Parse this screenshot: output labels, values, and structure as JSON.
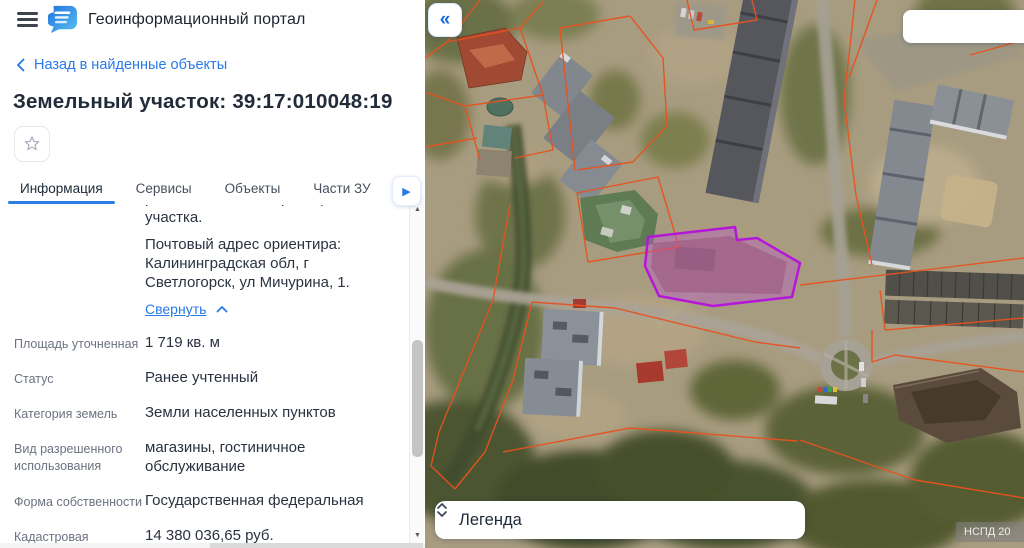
{
  "app": {
    "title": "Геоинформационный портал"
  },
  "back_link": {
    "label": "Назад в найденные объекты"
  },
  "object_title": "Земельный участок: 39:17:010048:19",
  "tabs": [
    {
      "label": "Информация",
      "active": true
    },
    {
      "label": "Сервисы",
      "active": false
    },
    {
      "label": "Объекты",
      "active": false
    },
    {
      "label": "Части ЗУ",
      "active": false
    },
    {
      "label": "Состав",
      "active": false
    }
  ],
  "description": {
    "clipped_line": "расположенного в границах участка.",
    "line2": "Почтовый адрес ориентира:",
    "line3": "Калининградская обл, г",
    "line4": "Светлогорск, ул Мичурина, 1.",
    "collapse_label": "Свернуть"
  },
  "fields": [
    {
      "label": "Площадь уточненная",
      "value": "1 719 кв. м"
    },
    {
      "label": "Статус",
      "value": "Ранее учтенный"
    },
    {
      "label": "Категория земель",
      "value": "Земли населенных пунктов"
    },
    {
      "label": "Вид разрешенного использования",
      "value": "магазины, гостиничное обслуживание"
    },
    {
      "label": "Форма собственности",
      "value": "Государственная федеральная"
    },
    {
      "label": "Кадастровая стоимость",
      "value": "14 380 036,65 руб."
    }
  ],
  "map": {
    "legend_label": "Легенда",
    "watermark": "НСПД 20",
    "search_value": "",
    "search_placeholder": ""
  },
  "icons": {
    "collapse_panel": "«",
    "tab_overflow": "▶",
    "scroll_up": "▲",
    "scroll_down": "▼"
  },
  "colors": {
    "accent_blue": "#2979e8",
    "cadastral_line": "#e8521f",
    "selected_parcel_stroke": "#b517d8",
    "selected_parcel_fill": "#bb55d3"
  }
}
